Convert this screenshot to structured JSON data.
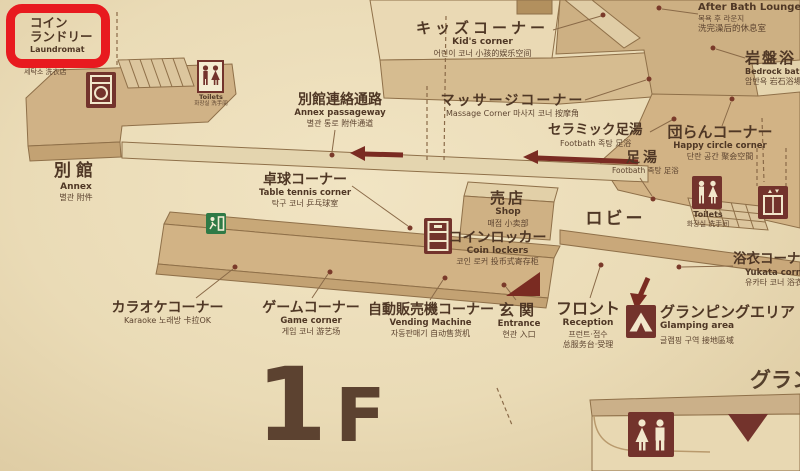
{
  "floor": {
    "number": "1",
    "letter": "F"
  },
  "highlight": {
    "jp_line1": "コイン",
    "jp_line2": "ランドリー",
    "en": "Laundromat",
    "sub": "세탁소 洗衣店"
  },
  "areas": {
    "kids_corner": {
      "jp": "キッズコーナー",
      "en": "Kid's corner",
      "sub": "어린이 코너 小孩的娱乐空间"
    },
    "after_bath_lounge": {
      "jp": "湯上がりラウンジ",
      "en": "After Bath Lounge",
      "kr": "목욕 후 라운지",
      "zh": "洗完澡后的休息室"
    },
    "bedrock_bath": {
      "jp": "岩盤浴",
      "en": "Bedrock bath",
      "sub": "암반욕 岩石浴場"
    },
    "annex_passageway": {
      "jp": "別館連絡通路",
      "en": "Annex passageway",
      "sub": "별관 통로 附件通道"
    },
    "massage_corner": {
      "jp": "マッサージコーナー",
      "sub": "Massage Corner 마사지 코너 按摩角"
    },
    "ceramic_footbath": {
      "jp": "セラミック足湯",
      "sub": "Footbath 족탕 足浴"
    },
    "happy_circle_corner": {
      "jp": "団らんコーナー",
      "en": "Happy circle corner",
      "sub": "단란 공간 聚会空間"
    },
    "footbath": {
      "jp": "足湯",
      "sub": "Footbath 족탕 足浴"
    },
    "annex": {
      "jp": "別館",
      "en": "Annex",
      "sub": "별관 附件"
    },
    "table_tennis_corner": {
      "jp": "卓球コーナー",
      "en": "Table tennis corner",
      "sub": "탁구 코너 乒乓球室"
    },
    "shop": {
      "jp": "売店",
      "en": "Shop",
      "sub": "매점 小卖部"
    },
    "lobby": {
      "jp": "ロビー"
    },
    "coin_lockers": {
      "jp": "コインロッカー",
      "en": "Coin lockers",
      "sub": "코인 로커 投币式寄存柜"
    },
    "toilets_upper_left": {
      "en": "Toilets",
      "sub": "화장실 洗手间"
    },
    "toilets_right": {
      "en": "Toilets",
      "sub": "화장실 洗手间"
    },
    "yukata_corner": {
      "jp": "浴衣コーナー",
      "en": "Yukata corner",
      "sub": "유카타 코너 浴衣角"
    },
    "karaoke_corner": {
      "jp": "カラオケコーナー",
      "sub": "Karaoke 노래방 卡拉OK"
    },
    "game_corner": {
      "jp": "ゲームコーナー",
      "en": "Game corner",
      "sub": "게임 코너 游艺场"
    },
    "vending_machine_corner": {
      "jp": "自動販売機コーナー",
      "en": "Vending Machine",
      "sub": "자동판매기 自动售货机"
    },
    "entrance": {
      "jp": "玄関",
      "en": "Entrance",
      "sub": "현관 入口"
    },
    "reception": {
      "jp": "フロント",
      "en": "Reception",
      "kr": "프런트·접수",
      "zh": "总服务台·受理"
    },
    "glamping_area": {
      "jp": "グランピングエリア",
      "en": "Glamping area",
      "sub": "글램핑 구역 接地區域"
    }
  },
  "partial": {
    "bottom_right": "グラン"
  },
  "icons": {
    "washing_machine": "washer-front-glyph",
    "toilets_small": "man-woman-figures",
    "emergency_exit": "running-man-door",
    "coin_locker": "locker-with-coin-slot",
    "toilets": "man-woman-figures",
    "elevator": "cabin-with-up-down-arrows",
    "tent": "tent-outline",
    "restroom_large": "woman-man-figures",
    "entrance_marker": "filled-right-triangle",
    "down_marker": "filled-down-triangle",
    "direction_arrows": "left-arrows-and-down-arrow"
  },
  "colors": {
    "highlight_red": "#e81a1f",
    "icon_maroon": "#73332c",
    "exit_green": "#2f7a46",
    "map_tan": "#d2b385",
    "text_brown": "#4f3725",
    "background_cream": "#eadbb6"
  }
}
